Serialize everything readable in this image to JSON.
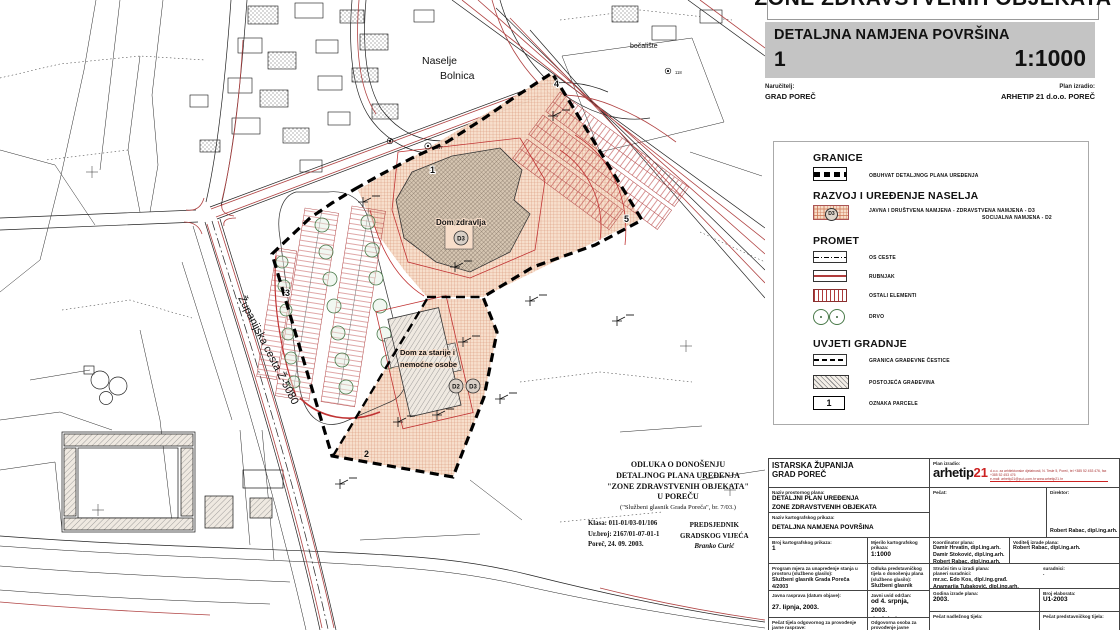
{
  "colors": {
    "zone_fill": "#f7ddc9",
    "zone_hatch": "#cc7755",
    "road_red": "#b04343",
    "curb_red": "#c03333",
    "tree_green": "#4a7a4a",
    "bar_gray": "#c4c4c4",
    "logo_red": "#cc2222",
    "boundary_black": "#000000"
  },
  "header": {
    "main_title": "ZONE ZDRAVSTVENIH OBJEKATA",
    "sheet_title": "DETALJNA NAMJENA POVRŠINA",
    "sheet_number": "1",
    "scale": "1:1000",
    "client_label": "Naručitelj:",
    "client_name": "GRAD POREČ",
    "author_label": "Plan izradio:",
    "author_name": "ARHETIP 21 d.o.o. POREČ"
  },
  "legend": {
    "granice_title": "GRANICE",
    "obuhvat_label": "OBUHVAT DETALJNOG PLANA UREĐENJA",
    "razvoj_title": "RAZVOJ I UREĐENJE NASELJA",
    "javna_label_1": "JAVNA I DRUŠTVENA NAMJENA -  ZDRAVSTVENA NAMJENA - D3",
    "javna_label_2": "SOCIJALNA NAMJENA - D2",
    "d3_badge": "D3",
    "promet_title": "PROMET",
    "os_ceste": "OS CESTE",
    "rubnjak": "RUBNJAK",
    "ostali_elementi": "OSTALI ELEMENTI",
    "drvo": "DRVO",
    "uvjeti_title": "UVJETI GRADNJE",
    "granica_cestice": "GRANICA GRAĐEVNE ČESTICE",
    "postojeca": "POSTOJEĆA GRAĐEVINA",
    "oznaka_parcele": "OZNAKA PARCELE",
    "oznaka_sample": "1"
  },
  "map": {
    "naselje_line1": "Naselje",
    "naselje_line2": "Bolnica",
    "bocaliste": "bočalište",
    "dom_zdravlja": "Dom zdravlja",
    "dom_starije_1": "Dom za starije i",
    "dom_starije_2": "nemoćne osobe",
    "zupanijska": "Županijska cesta Ž-5080",
    "d3": "D3",
    "d2": "D2",
    "p1": "1",
    "p2": "2",
    "p3": "3",
    "p4": "4",
    "p5": "5",
    "pt117": "117",
    "pt118": "118"
  },
  "odluka": {
    "line1": "ODLUKA O DONOŠENJU",
    "line2": "DETALJNOG PLANA UREĐENJA",
    "line3": "\"ZONE ZDRAVSTVENIH OBJEKATA\"",
    "line4": "U POREČU",
    "line5": "(\"Službeni glasnik Grada Poreča\", br. 7/03.)",
    "klasa": "Klasa: 011-01/03-01/106",
    "urbroj": "Ur.broj: 2167/01-07-01-1",
    "datum": "Poreč, 24. 09. 2003.",
    "pred1": "PREDSJEDNIK",
    "pred2": "GRADSKOG VIJEĆA",
    "pred3": "Branko Curić"
  },
  "title_block": {
    "zupanija": "ISTARSKA ŽUPANIJA",
    "grad": "GRAD POREČ",
    "plan_izradio_label": "Plan izradio:",
    "logo_main": "arhetip",
    "logo_21": "21",
    "logo_small_1": "d.o.o. za arhitektonske djelatnosti, N. Tesle 5, Poreč, tel +385 52 453 476, fax +385 52 453 476",
    "logo_small_2": "e-mail: arhetip21@pu.t-com.hr            www.arhetip21.hr",
    "naziv_plana_label": "Naziv prostornog plana:",
    "naziv_plana_1": "DETALJNI PLAN UREĐENJA",
    "naziv_plana_2": "ZONE ZDRAVSTVENIH OBJEKATA",
    "naziv_prikaza_label": "Naziv kartografskog prikaza:",
    "naziv_prikaza": "DETALJNA NAMJENA POVRŠINA",
    "pecat_label": "Pečat:",
    "direktor_label": "Direktor:",
    "direktor_name": "Robert Rabac, dipl.ing.arh.",
    "broj_prikaza_label": "Broj kartografskog prikaza:",
    "broj_prikaza": "1",
    "mjerilo_label": "Mjerilo kartografskog prikaza:",
    "mjerilo": "1:1000",
    "koordinator_label": "Koordinator plana:",
    "koordinator_1": "Damir Hrvatin, dipl.ing.arh.",
    "koordinator_2": "Damir Stoković, dipl.ing.arh.",
    "koordinator_3": "Robert Rabac, dipl.ing.arh.",
    "voditelj_label": "Voditelj izrade plana:",
    "voditelj_name": "Robert Rabac, dipl.ing.arh.",
    "program_label": "Program mjera za unapređenje stanja u prostoru (službeno glasilo):",
    "program_value_1": "Službeni glasnik Grada Poreča",
    "program_value_2": "4/2003",
    "odluka_label": "Odluka predstavničkog tijela o donošenju plana (službeno glasilo):",
    "odluka_value_1": "Službeni glasnik Grada Poreča",
    "odluka_value_2": "7/2003",
    "strucni_label_1": "Stručni tim u izradi plana:",
    "strucni_label_2": "planeri suradnici:",
    "strucni_1": "mr.sc. Edo Kos, dipl.ing.građ.",
    "strucni_2": "Anamarija Tubaković, dipl.ing.arh.",
    "suradnici_label": "suradnici:",
    "suradnici_value": ".",
    "javna_label": "Javna rasprava (datum objave):",
    "javna_value": "27. lipnja, 2003.",
    "uvid_label": "Javni uvid održan:",
    "uvid_value_1": "od 4. srpnja, 2003.",
    "uvid_value_2": "do 4. kolovoza, 2003.",
    "godina_label": "Godina izrade plana:",
    "godina_value": "2003.",
    "elaborat_label": "Broj elaborata:",
    "elaborat_value": "U1-2003",
    "pecat_tijela_label": "Pečat tijela odgovornog za provođenje javne rasprave:",
    "odgovorna_label": "Odgovorna osoba za provođenje javne rasprave:",
    "pecat_nadleznog_label": "Pečat nadležnog tijela:",
    "pecat_predstavnickog_label": "Pečat predstavničkog tijela:"
  }
}
